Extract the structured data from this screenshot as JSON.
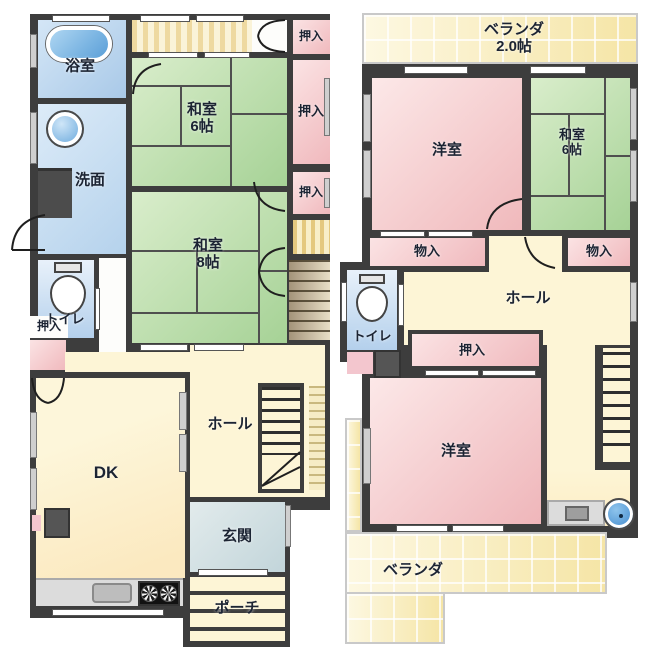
{
  "floor1": {
    "bath": "浴室",
    "washroom": "洗面",
    "toilet": "トイレ",
    "oshiire_toilet": "押入",
    "washitsu6": "和室\n6帖",
    "washitsu8": "和室\n8帖",
    "oshiire_corner": "押入",
    "oshiire_right1": "押入",
    "oshiire_right2": "押入",
    "dk": "DK",
    "hall": "ホール",
    "genkan": "玄関",
    "porch": "ポーチ"
  },
  "floor2": {
    "veranda_top": "ベランダ\n2.0帖",
    "yoshitsu_top": "洋室",
    "washitsu6": "和室\n6帖",
    "monoire_left": "物入",
    "monoire_right": "物入",
    "hall": "ホール",
    "toilet": "トイレ",
    "oshiire": "押入",
    "yoshitsu_bottom": "洋室",
    "veranda_bottom": "ベランダ"
  },
  "colors": {
    "wall": "#3d3d3d",
    "text": "#1c2433",
    "tatami_light": "#d9edcb",
    "tatami_dark": "#a6d296",
    "pink_light": "#fbe3e4",
    "pink_dark": "#f0b9bd",
    "blue_light": "#d4e6f6",
    "blue_dark": "#a9c9e8",
    "cream": "#fdf5d6",
    "veranda": "#f8edbb",
    "stripe_tan": "#eed9a0",
    "fixture_blue": "#5aa7e0",
    "appliance": "#4c4c4c",
    "counter": "#dcdcdc"
  }
}
